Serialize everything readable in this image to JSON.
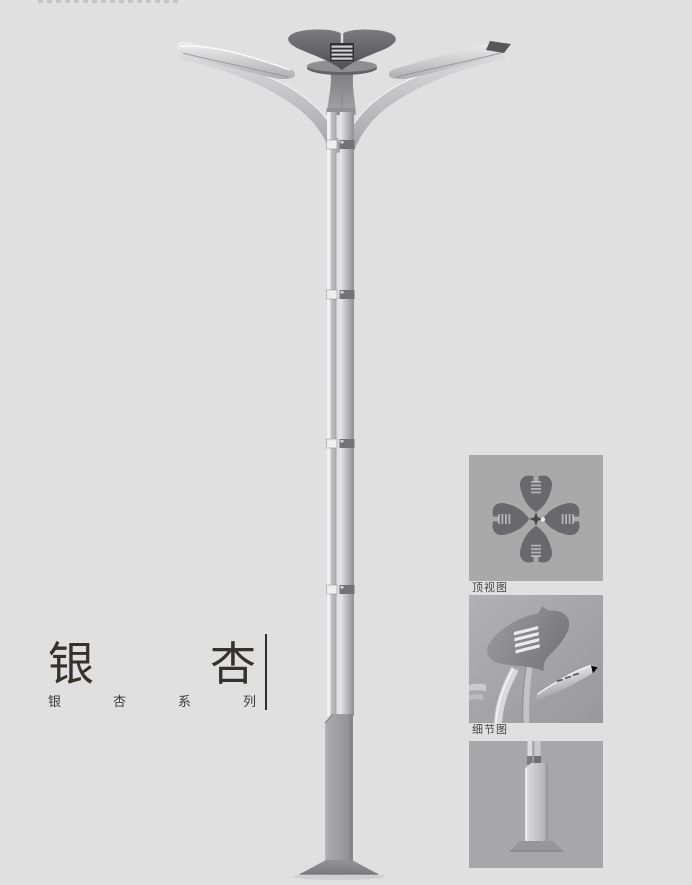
{
  "page": {
    "background": "#e0e0e1"
  },
  "title_block": {
    "title_chars": [
      "银",
      "杏"
    ],
    "subtitle_chars": [
      "银",
      "杏",
      "系",
      "列"
    ]
  },
  "figures": [
    {
      "name": "top-view",
      "label": "顶视图"
    },
    {
      "name": "detail-view",
      "label": "细节图"
    },
    {
      "name": "base-view",
      "label": ""
    }
  ],
  "colors": {
    "page_bg": "#e0e0e1",
    "figure_bg": "#a9a9aa",
    "crown_dark": "#5a5a5e",
    "pole_light": "#c9c9cb",
    "base_column": "#98989a",
    "title_text": "#35322e",
    "label_text": "#454545"
  }
}
